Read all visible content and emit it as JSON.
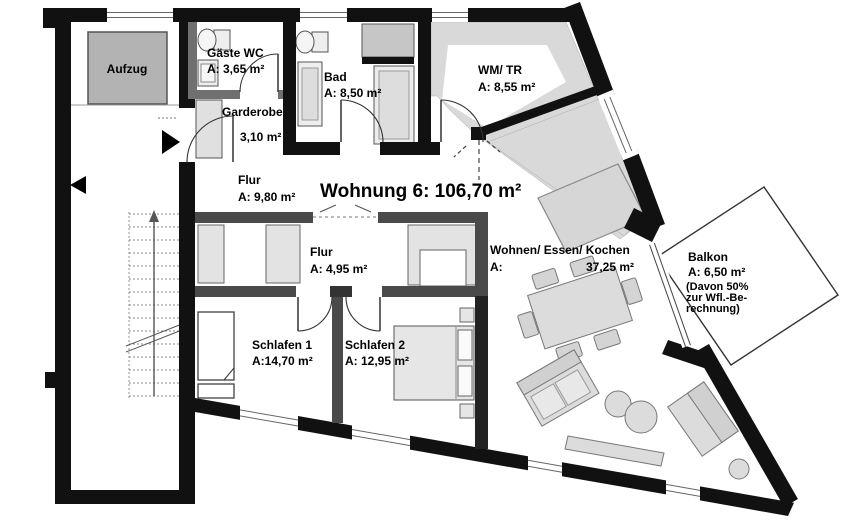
{
  "plan": {
    "title": "Wohnung 6: 106,70 m²",
    "rooms": {
      "aufzug": {
        "name": "Aufzug"
      },
      "gaeste_wc": {
        "name": "Gäste WC",
        "area": "A: 3,65 m²"
      },
      "garderobe": {
        "name": "Garderobe",
        "area": "3,10 m²"
      },
      "bad": {
        "name": "Bad",
        "area": "A: 8,50 m²"
      },
      "wm_tr": {
        "name": "WM/ TR",
        "area": "A: 8,55 m²"
      },
      "flur": {
        "name": "Flur",
        "area": "A: 9,80 m²"
      },
      "flur_innen": {
        "name": "Flur",
        "area": "A: 4,95 m²"
      },
      "wohnen": {
        "name": "Wohnen/ Essen/ Kochen",
        "area_prefix": "A:",
        "area": "37,25 m²"
      },
      "schlafen1": {
        "name": "Schlafen 1",
        "area": "A:14,70 m²"
      },
      "schlafen2": {
        "name": "Schlafen 2",
        "area": "A: 12,95 m²"
      },
      "balkon": {
        "name": "Balkon",
        "area": "A:  6,50 m²",
        "note_line1": "(Davon 50%",
        "note_line2": "zur Wfl.-Be-",
        "note_line3": "rechnung)"
      }
    },
    "colors": {
      "wall": "#111111",
      "partition": "#4a4a4a",
      "furniture_fill": "#dcdcdc",
      "roof_shade": "#d9d9d9",
      "elevator_fill": "#b3b3b3"
    }
  }
}
